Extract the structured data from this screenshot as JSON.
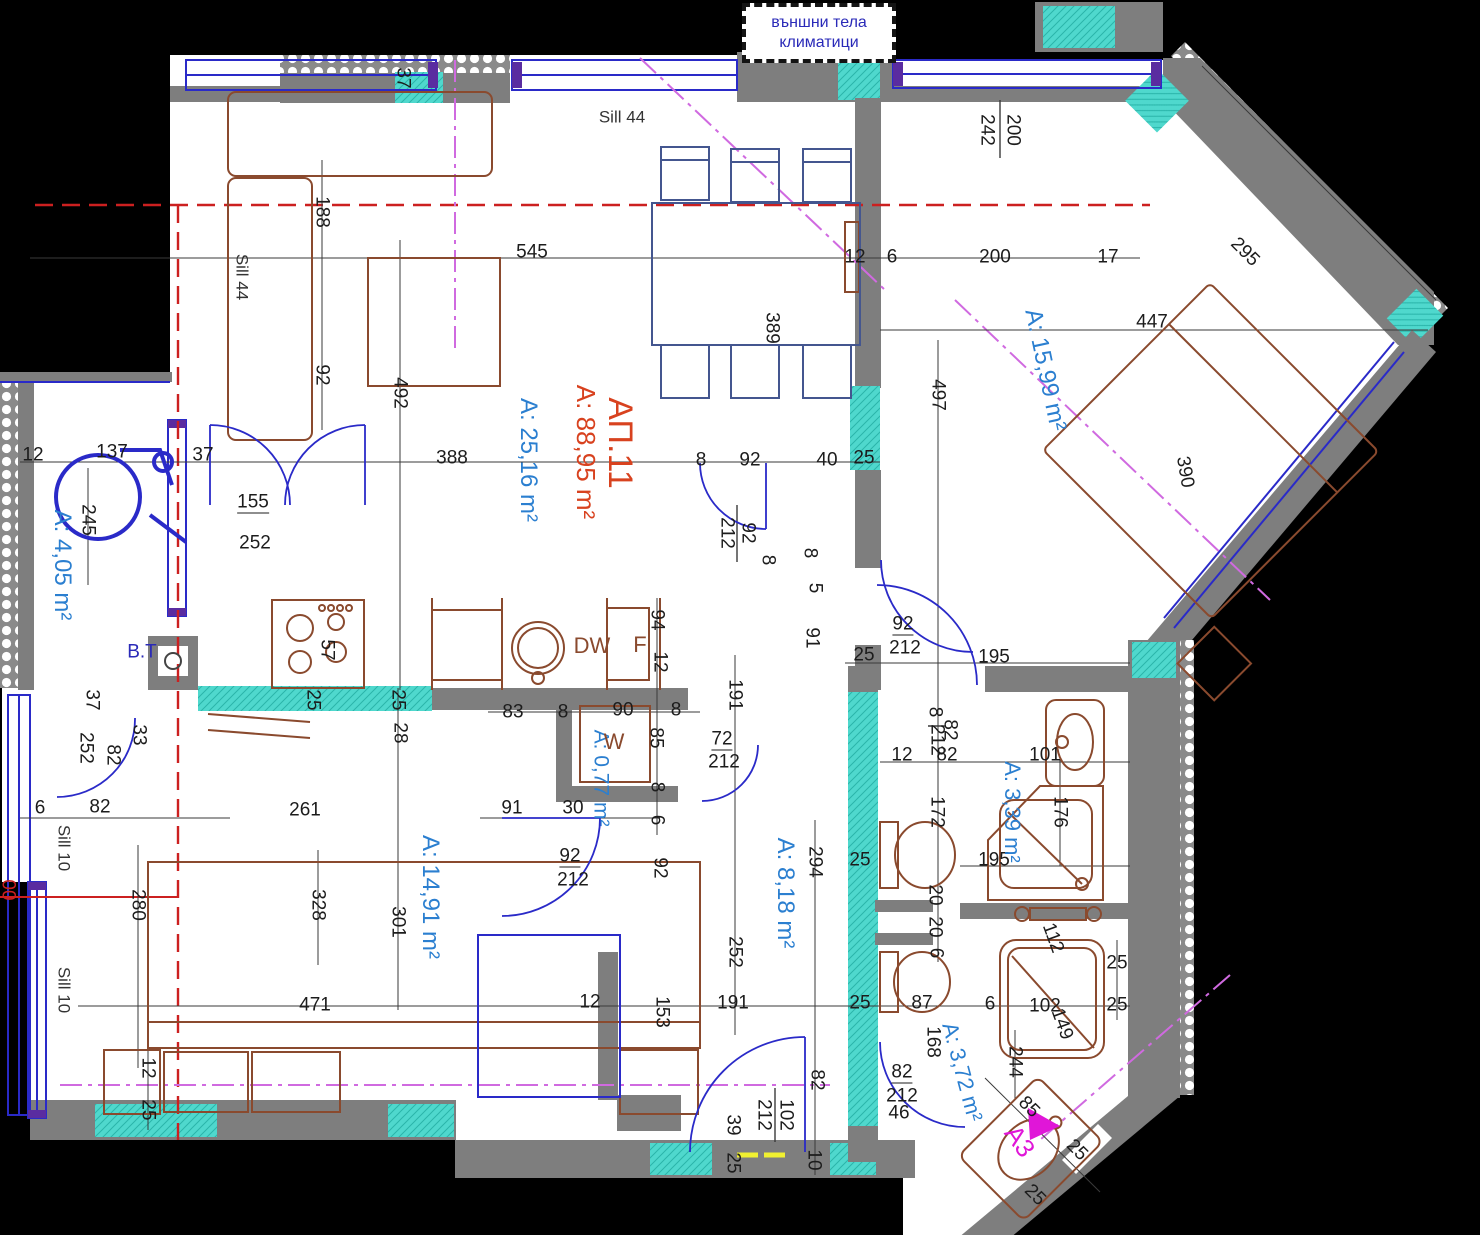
{
  "note": {
    "line1": "външни тела",
    "line2": "климатици"
  },
  "apartment": {
    "id": "АП.11",
    "total_area": "A: 88,95 m²"
  },
  "colors": {
    "wall_gray": "#7e7e7e",
    "teal": "#4fd8cd",
    "window_blue": "#2a2ac8",
    "furniture_brown": "#8a4a2e",
    "area_blue": "#2b7fd0",
    "apartment_red": "#d8421f",
    "magenta": "#e016d8",
    "red_axis": "#cc2020"
  },
  "room_labels": [
    {
      "t": "АП.11",
      "x": 620,
      "y": 443,
      "r": 90,
      "cls": "redlbl",
      "size": 34
    },
    {
      "t": "A: 88,95 m²",
      "x": 586,
      "y": 452,
      "r": 90,
      "cls": "redlbl",
      "size": 26
    },
    {
      "t": "A: 25,16 m²",
      "x": 528,
      "y": 460,
      "r": 90,
      "cls": "blue",
      "size": 24
    },
    {
      "t": "A: 15,99 m²",
      "x": 1045,
      "y": 370,
      "r": 78,
      "cls": "blue",
      "size": 24
    },
    {
      "t": "A: 4,05 m²",
      "x": 62,
      "y": 565,
      "r": 90,
      "cls": "blue",
      "size": 24
    },
    {
      "t": "A: 14,91 m²",
      "x": 430,
      "y": 897,
      "r": 90,
      "cls": "blue",
      "size": 24
    },
    {
      "t": "A: 8,18 m²",
      "x": 785,
      "y": 893,
      "r": 90,
      "cls": "blue",
      "size": 24
    },
    {
      "t": "A: 0,77 m²",
      "x": 601,
      "y": 778,
      "r": 90,
      "cls": "blue",
      "size": 21
    },
    {
      "t": "A: 3,39 m²",
      "x": 1012,
      "y": 812,
      "r": 90,
      "cls": "blue",
      "size": 22
    },
    {
      "t": "A: 3,72 m²",
      "x": 962,
      "y": 1072,
      "r": 75,
      "cls": "blue",
      "size": 22
    },
    {
      "t": "A3",
      "x": 1020,
      "y": 1141,
      "r": 55,
      "cls": "magenta",
      "size": 26
    },
    {
      "t": "DW",
      "x": 592,
      "y": 646,
      "r": 0,
      "cls": "brown",
      "size": 22
    },
    {
      "t": "F",
      "x": 640,
      "y": 645,
      "r": 0,
      "cls": "brown",
      "size": 22
    },
    {
      "t": "W",
      "x": 614,
      "y": 742,
      "r": 0,
      "cls": "brown",
      "size": 22
    },
    {
      "t": "B.T",
      "x": 142,
      "y": 652,
      "r": 0,
      "cls": "navy",
      "size": 19
    }
  ],
  "dimensions": [
    {
      "t": "Sill 44",
      "x": 622,
      "y": 117,
      "cls": "sill"
    },
    {
      "t": "545",
      "x": 532,
      "y": 252
    },
    {
      "t": "12",
      "x": 855,
      "y": 257
    },
    {
      "t": "6",
      "x": 892,
      "y": 257
    },
    {
      "t": "200",
      "x": 995,
      "y": 257
    },
    {
      "t": "17",
      "x": 1108,
      "y": 257
    },
    {
      "t": "295",
      "x": 1245,
      "y": 252,
      "r": 45
    },
    {
      "t": "242",
      "x": 987,
      "y": 130,
      "r": 90
    },
    {
      "t": "200",
      "x": 1013,
      "y": 130,
      "r": 90
    },
    {
      "t": "188",
      "x": 322,
      "y": 212,
      "r": 90
    },
    {
      "t": "Sill 44",
      "x": 242,
      "y": 277,
      "r": 90,
      "cls": "sill"
    },
    {
      "t": "92",
      "x": 322,
      "y": 375,
      "r": 90
    },
    {
      "t": "492",
      "x": 400,
      "y": 393,
      "r": 90
    },
    {
      "t": "389",
      "x": 772,
      "y": 328,
      "r": 90
    },
    {
      "t": "447",
      "x": 1152,
      "y": 322
    },
    {
      "t": "390",
      "x": 1185,
      "y": 472,
      "r": 80
    },
    {
      "t": "497",
      "x": 938,
      "y": 395,
      "r": 90
    },
    {
      "t": "37",
      "x": 403,
      "y": 78,
      "r": 90
    },
    {
      "t": "388",
      "x": 452,
      "y": 458
    },
    {
      "t": "8",
      "x": 701,
      "y": 460
    },
    {
      "t": "92",
      "x": 750,
      "y": 460
    },
    {
      "t": "40",
      "x": 827,
      "y": 460
    },
    {
      "t": "25",
      "x": 864,
      "y": 458
    },
    {
      "t": "12",
      "x": 33,
      "y": 455
    },
    {
      "t": "137",
      "x": 112,
      "y": 452
    },
    {
      "t": "37",
      "x": 203,
      "y": 455
    },
    {
      "t": "245",
      "x": 88,
      "y": 520,
      "r": 90
    },
    {
      "t": "155",
      "x": 253,
      "y": 503,
      "u": true
    },
    {
      "t": "252",
      "x": 255,
      "y": 543
    },
    {
      "t": "92",
      "x": 748,
      "y": 533,
      "r": 90
    },
    {
      "t": "212",
      "x": 727,
      "y": 533,
      "r": 90
    },
    {
      "t": "8",
      "x": 768,
      "y": 560,
      "r": 90
    },
    {
      "t": "8",
      "x": 810,
      "y": 553,
      "r": 90
    },
    {
      "t": "5",
      "x": 815,
      "y": 588,
      "r": 90
    },
    {
      "t": "57",
      "x": 327,
      "y": 650,
      "r": 90
    },
    {
      "t": "94",
      "x": 657,
      "y": 620,
      "r": 90
    },
    {
      "t": "12",
      "x": 660,
      "y": 662,
      "r": 90
    },
    {
      "t": "25",
      "x": 313,
      "y": 700,
      "r": 90
    },
    {
      "t": "25",
      "x": 398,
      "y": 700,
      "r": 90
    },
    {
      "t": "28",
      "x": 400,
      "y": 733,
      "r": 90
    },
    {
      "t": "83",
      "x": 513,
      "y": 712
    },
    {
      "t": "8",
      "x": 563,
      "y": 712
    },
    {
      "t": "90",
      "x": 623,
      "y": 710
    },
    {
      "t": "8",
      "x": 676,
      "y": 710
    },
    {
      "t": "191",
      "x": 735,
      "y": 695,
      "r": 90
    },
    {
      "t": "85",
      "x": 656,
      "y": 738,
      "r": 90
    },
    {
      "t": "72",
      "x": 722,
      "y": 740,
      "u": true
    },
    {
      "t": "212",
      "x": 724,
      "y": 762
    },
    {
      "t": "8",
      "x": 657,
      "y": 787,
      "r": 90
    },
    {
      "t": "6",
      "x": 657,
      "y": 820,
      "r": 90
    },
    {
      "t": "30",
      "x": 573,
      "y": 808
    },
    {
      "t": "91",
      "x": 512,
      "y": 808
    },
    {
      "t": "92",
      "x": 570,
      "y": 857,
      "u": true
    },
    {
      "t": "212",
      "x": 573,
      "y": 880
    },
    {
      "t": "92",
      "x": 660,
      "y": 868,
      "r": 90
    },
    {
      "t": "37",
      "x": 92,
      "y": 700,
      "r": 90
    },
    {
      "t": "252",
      "x": 86,
      "y": 748,
      "r": 90
    },
    {
      "t": "82",
      "x": 113,
      "y": 755,
      "r": 90
    },
    {
      "t": "33",
      "x": 139,
      "y": 735,
      "r": 90
    },
    {
      "t": "6",
      "x": 40,
      "y": 808
    },
    {
      "t": "82",
      "x": 100,
      "y": 807
    },
    {
      "t": "Sill 10",
      "x": 64,
      "y": 848,
      "r": 90,
      "cls": "sill"
    },
    {
      "t": "Sill 10",
      "x": 64,
      "y": 990,
      "r": 90,
      "cls": "sill"
    },
    {
      "t": "00",
      "x": 8,
      "y": 890,
      "r": 90,
      "cls": "red"
    },
    {
      "t": "280",
      "x": 138,
      "y": 905,
      "r": 90
    },
    {
      "t": "261",
      "x": 305,
      "y": 810
    },
    {
      "t": "328",
      "x": 318,
      "y": 905,
      "r": 90
    },
    {
      "t": "301",
      "x": 398,
      "y": 922,
      "r": 90
    },
    {
      "t": "471",
      "x": 315,
      "y": 1005
    },
    {
      "t": "12",
      "x": 148,
      "y": 1068,
      "r": 90
    },
    {
      "t": "25",
      "x": 148,
      "y": 1110,
      "r": 90
    },
    {
      "t": "294",
      "x": 815,
      "y": 862,
      "r": 90
    },
    {
      "t": "252",
      "x": 735,
      "y": 952,
      "r": 90
    },
    {
      "t": "191",
      "x": 733,
      "y": 1003
    },
    {
      "t": "25",
      "x": 860,
      "y": 860
    },
    {
      "t": "25",
      "x": 860,
      "y": 1003
    },
    {
      "t": "87",
      "x": 922,
      "y": 1003
    },
    {
      "t": "20",
      "x": 935,
      "y": 895,
      "r": 90
    },
    {
      "t": "6",
      "x": 936,
      "y": 953,
      "r": 90
    },
    {
      "t": "91",
      "x": 812,
      "y": 638,
      "r": 90
    },
    {
      "t": "92",
      "x": 903,
      "y": 625,
      "u": true
    },
    {
      "t": "212",
      "x": 905,
      "y": 648
    },
    {
      "t": "25",
      "x": 864,
      "y": 655
    },
    {
      "t": "195",
      "x": 994,
      "y": 657
    },
    {
      "t": "8",
      "x": 935,
      "y": 712,
      "r": 90
    },
    {
      "t": "212",
      "x": 937,
      "y": 740,
      "r": 90
    },
    {
      "t": "12",
      "x": 902,
      "y": 755
    },
    {
      "t": "82",
      "x": 950,
      "y": 730,
      "r": 90
    },
    {
      "t": "82",
      "x": 947,
      "y": 755
    },
    {
      "t": "101",
      "x": 1045,
      "y": 755
    },
    {
      "t": "176",
      "x": 1060,
      "y": 812,
      "r": 90
    },
    {
      "t": "172",
      "x": 937,
      "y": 812,
      "r": 90
    },
    {
      "t": "195",
      "x": 994,
      "y": 860
    },
    {
      "t": "20",
      "x": 935,
      "y": 927,
      "r": 90
    },
    {
      "t": "112",
      "x": 1053,
      "y": 938,
      "r": 70
    },
    {
      "t": "168",
      "x": 933,
      "y": 1042,
      "r": 90
    },
    {
      "t": "6",
      "x": 990,
      "y": 1004
    },
    {
      "t": "102",
      "x": 1045,
      "y": 1006
    },
    {
      "t": "149",
      "x": 1062,
      "y": 1024,
      "r": 70
    },
    {
      "t": "244",
      "x": 1015,
      "y": 1062,
      "r": 90
    },
    {
      "t": "85",
      "x": 1029,
      "y": 1107,
      "r": 45
    },
    {
      "t": "25",
      "x": 1117,
      "y": 963
    },
    {
      "t": "25",
      "x": 1117,
      "y": 1005
    },
    {
      "t": "25",
      "x": 1077,
      "y": 1150,
      "r": 45
    },
    {
      "t": "25",
      "x": 1035,
      "y": 1195,
      "r": 45
    },
    {
      "t": "82",
      "x": 817,
      "y": 1080,
      "r": 90
    },
    {
      "t": "82",
      "x": 902,
      "y": 1073,
      "u": true
    },
    {
      "t": "212",
      "x": 902,
      "y": 1096
    },
    {
      "t": "46",
      "x": 899,
      "y": 1113
    },
    {
      "t": "10",
      "x": 814,
      "y": 1160,
      "r": 90
    },
    {
      "t": "39",
      "x": 733,
      "y": 1125,
      "r": 90
    },
    {
      "t": "25",
      "x": 733,
      "y": 1163,
      "r": 90
    },
    {
      "t": "102",
      "x": 786,
      "y": 1115,
      "r": 90
    },
    {
      "t": "212",
      "x": 764,
      "y": 1115,
      "r": 90
    },
    {
      "t": "12",
      "x": 590,
      "y": 1002
    },
    {
      "t": "153",
      "x": 662,
      "y": 1012,
      "r": 90
    }
  ]
}
